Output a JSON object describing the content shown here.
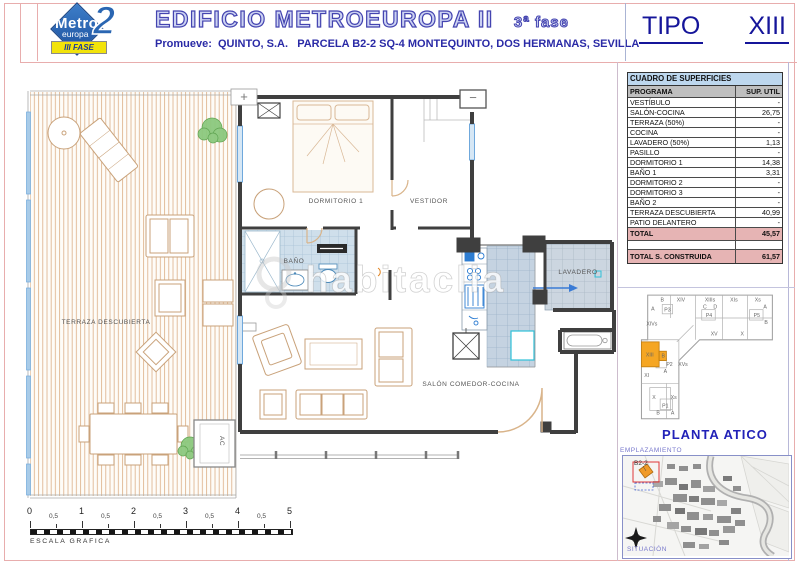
{
  "header": {
    "logo": {
      "name": "Metro",
      "sub": "europa",
      "num": "2",
      "badge": "III FASE"
    },
    "title": "EDIFICIO METROEUROPA II",
    "phase": "3ª fase",
    "promoter": "Promueve:  QUINTO, S.A.   PARCELA B2-2 SQ-4 MONTEQUINTO, DOS HERMANAS, SEVILLA",
    "tipo_label": "TIPO",
    "tipo_value": "XIII"
  },
  "surface_table": {
    "title": "CUADRO DE SUPERFICIES",
    "columns": {
      "program": "PROGRAMA",
      "area": "SUP. UTIL"
    },
    "rows": [
      [
        "VESTÍBULO",
        "-"
      ],
      [
        "SALÓN-COCINA",
        "26,75"
      ],
      [
        "TERRAZA (50%)",
        "-"
      ],
      [
        "COCINA",
        "-"
      ],
      [
        "LAVADERO (50%)",
        "1,13"
      ],
      [
        "PASILLO",
        "-"
      ],
      [
        "DORMITORIO 1",
        "14,38"
      ],
      [
        "BAÑO 1",
        "3,31"
      ],
      [
        "DORMITORIO 2",
        "-"
      ],
      [
        "DORMITORIO 3",
        "-"
      ],
      [
        "BAÑO 2",
        "-"
      ],
      [
        "TERRAZA DESCUBIERTA",
        "40,99"
      ],
      [
        "PATIO DELANTERO",
        "-"
      ]
    ],
    "total": {
      "label": "TOTAL",
      "value": "45,57"
    },
    "total_built": {
      "label": "TOTAL S. CONSTRUIDA",
      "value": "61,57"
    }
  },
  "floor_plan": {
    "labels": {
      "terrace": "TERRAZA DESCUBIERTA",
      "bedroom": "DORMITORIO 1",
      "dressing": "VESTIDOR",
      "bathroom": "BAÑO",
      "laundry": "LAVADERO",
      "living": "SALÓN COMEDOR-COCINA",
      "ac": "AC"
    },
    "symbols": {
      "plus": "+",
      "minus": "−"
    },
    "watermark": "habitaclia"
  },
  "key_plan": {
    "caption": "PLANTA ATICO",
    "highlighted_unit": "XIII",
    "highlight_color": "#F5A623",
    "units": [
      {
        "t": "B",
        "x": 30,
        "y": 9
      },
      {
        "t": "XIV",
        "x": 48,
        "y": 9
      },
      {
        "t": "XIIIs",
        "x": 76,
        "y": 9
      },
      {
        "t": "XIs",
        "x": 99,
        "y": 9
      },
      {
        "t": "Xs",
        "x": 122,
        "y": 9
      },
      {
        "t": "A",
        "x": 21,
        "y": 18
      },
      {
        "t": "P3",
        "x": 35,
        "y": 19
      },
      {
        "t": "XIVs",
        "x": 20,
        "y": 32
      },
      {
        "t": "C",
        "x": 71,
        "y": 16
      },
      {
        "t": "D",
        "x": 81,
        "y": 16
      },
      {
        "t": "P4",
        "x": 75,
        "y": 24
      },
      {
        "t": "XV",
        "x": 80,
        "y": 42
      },
      {
        "t": "A",
        "x": 129,
        "y": 16
      },
      {
        "t": "P5",
        "x": 121,
        "y": 24
      },
      {
        "t": "B",
        "x": 130,
        "y": 31
      },
      {
        "t": "X",
        "x": 107,
        "y": 42
      },
      {
        "t": "XIII",
        "x": 18,
        "y": 62
      },
      {
        "t": "B",
        "x": 31,
        "y": 63
      },
      {
        "t": "P2",
        "x": 37,
        "y": 71
      },
      {
        "t": "XVs",
        "x": 50,
        "y": 71
      },
      {
        "t": "A",
        "x": 33,
        "y": 78
      },
      {
        "t": "XI",
        "x": 15,
        "y": 82
      },
      {
        "t": "X",
        "x": 22,
        "y": 103
      },
      {
        "t": "Xs",
        "x": 41,
        "y": 103
      },
      {
        "t": "P1",
        "x": 33,
        "y": 111
      },
      {
        "t": "B",
        "x": 26,
        "y": 118
      },
      {
        "t": "A",
        "x": 40,
        "y": 118
      }
    ]
  },
  "location_map": {
    "title": "EMPLAZAMIENTO",
    "parcel": "B2-2",
    "caption": "SITUACIÓN"
  },
  "scale_bar": {
    "label": "ESCALA GRAFICA",
    "majors": [
      "0",
      "1",
      "2",
      "3",
      "4",
      "5"
    ],
    "minor": "0,5"
  },
  "colors": {
    "accent_blue": "#4444B0",
    "tipo_navy": "#15159A",
    "frame_pink": "#E8ADAD",
    "total_row_pink": "#E6B4B4",
    "table_header_blue": "#BDD7EE",
    "table_header_gray": "#BFBFBF",
    "highlight_orange": "#F5A623",
    "wall_gray": "#3F3F3F",
    "tile_blue": "#CFDFEB",
    "deck_tan": "#DCAE86",
    "window_blue": "#6FA8DC"
  }
}
